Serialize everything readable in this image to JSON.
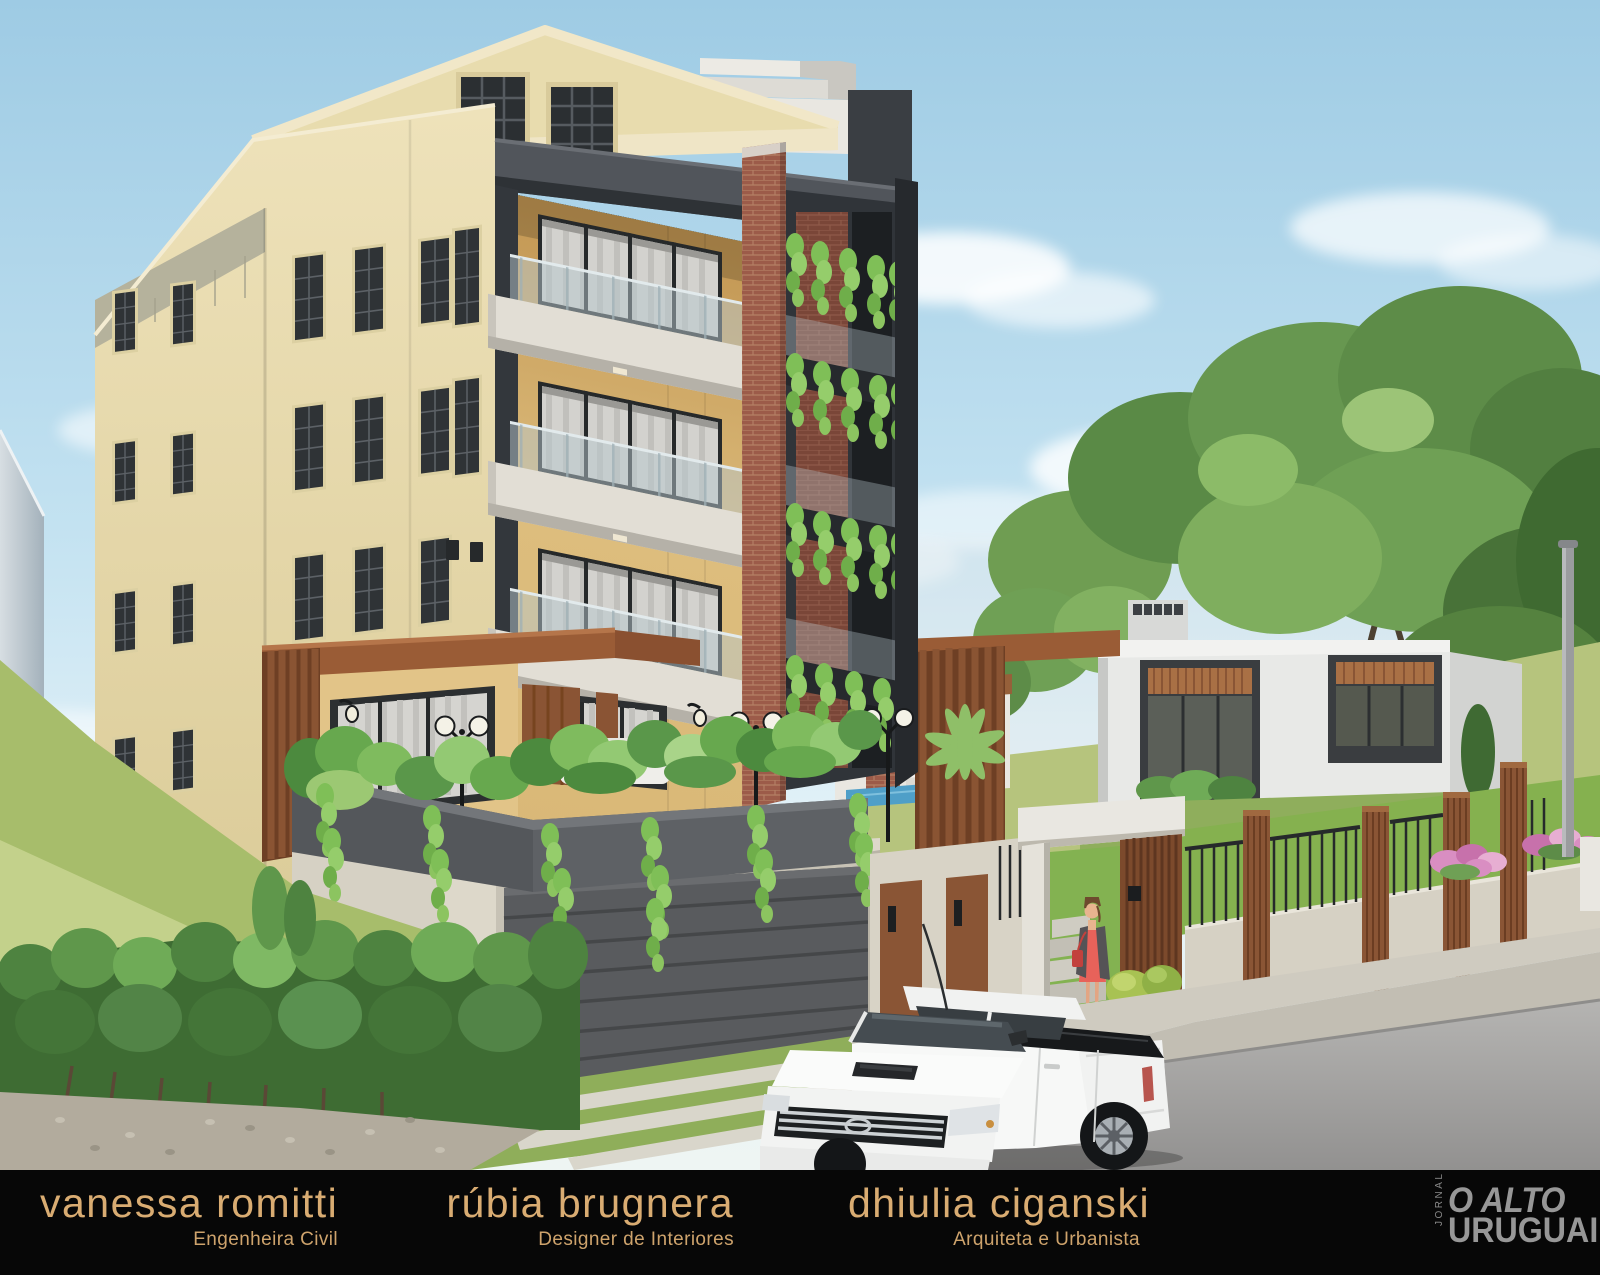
{
  "image": {
    "kind": "architectural exterior 3D rendering",
    "subject": "Four-story cream apartment building with gabled attic, dark roof slabs, glass-railing balconies, brick pillar, planted terrace over a garage, modern entrance portal with a woman in a red dress, white double-cab pickup truck parked on the street, wood-slat and metal fence, modern white single-story house, large trees and blue sky with clouds",
    "palette": {
      "sky_top": "#9ecbe4",
      "sky_horizon": "#eef5f3",
      "building_cream": "#e8dcae",
      "building_gold": "#d9b877",
      "dark_structure": "#3a3e43",
      "brick": "#9c5b49",
      "wood": "#8a5535",
      "balcony_parapet": "#e2ded5",
      "foliage": "#5f974b",
      "grass": "#8fae5a",
      "street": "#a7a6a4",
      "white_house": "#e8e9e7",
      "truck_white": "#f4f5f4",
      "credits_gold": "#d9ac72",
      "credits_bg": "#070707",
      "logo_gray": "#979797"
    }
  },
  "credits": {
    "people": [
      {
        "name": "vanessa romitti",
        "role": "Engenheira Civil"
      },
      {
        "name": "rúbia brugnera",
        "role": "Designer de Interiores"
      },
      {
        "name": "dhiulia ciganski",
        "role": "Arquiteta e Urbanista"
      }
    ]
  },
  "logo": {
    "kicker": "JORNAL",
    "line1": "O ALTO",
    "line2": "URUGUAI"
  }
}
